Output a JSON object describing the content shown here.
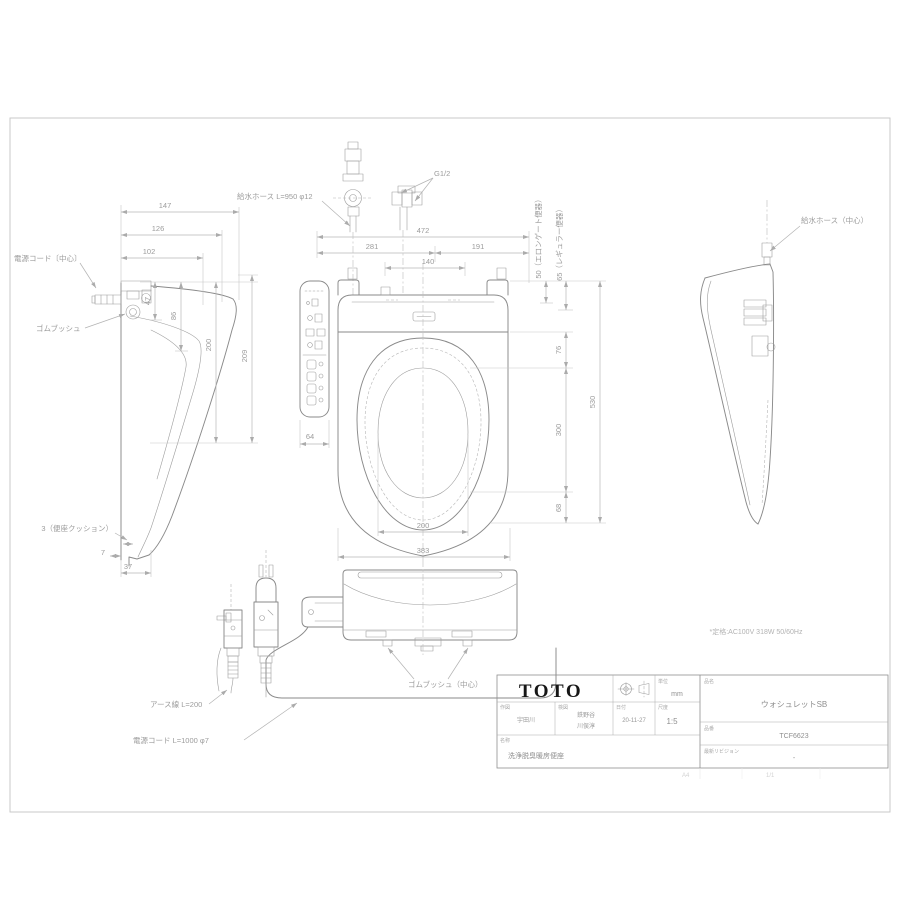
{
  "drawing": {
    "rating": "*定格:AC100V 318W 50/60Hz",
    "labels": {
      "power_cord_center": "電源コード〔中心〕",
      "rubber_bush": "ゴムブッシュ",
      "supply_hose": "給水ホース L=950 φ12",
      "g_thread": "G1/2",
      "supply_hose_right": "給水ホース（中心）",
      "seat_cushion": "3（便座クッション）",
      "earth_wire": "アース線 L=200",
      "power_cord": "電源コード L=1000 φ7",
      "rubber_bush_center": "ゴムブッシュ（中心）"
    },
    "dims": {
      "d147": "147",
      "d126": "126",
      "d102": "102",
      "d47": "47",
      "d86": "86",
      "dl200": "200",
      "d209": "209",
      "d7": "7",
      "d37": "37",
      "d472": "472",
      "d281": "281",
      "d191": "191",
      "d140": "140",
      "d64": "64",
      "d50": "50（エロンゲート便器）",
      "d65": "65（レギュラー便器）",
      "d76": "76",
      "d300": "300",
      "d68": "68",
      "d530": "530",
      "dt200": "200",
      "d383": "383"
    }
  },
  "title_block": {
    "logo": "TOTO",
    "unit_label": "単位",
    "unit_value": "mm",
    "drafter_label": "作図",
    "drafter": "宇田川",
    "checker_label": "検図",
    "checker1": "鉄野谷",
    "checker2": "川俣淳",
    "date_label": "日付",
    "date": "20-11-27",
    "scale_label": "尺度",
    "scale": "1:5",
    "name_label": "名称",
    "name": "洗浄脱臭暖房便座",
    "product_label": "品名",
    "product": "ウォシュレットSB",
    "number_label": "品番",
    "number": "TCF6623",
    "revision_label": "最新リビジョン",
    "revision": "-",
    "footer_size": "A4",
    "footer_page": "1/1"
  }
}
